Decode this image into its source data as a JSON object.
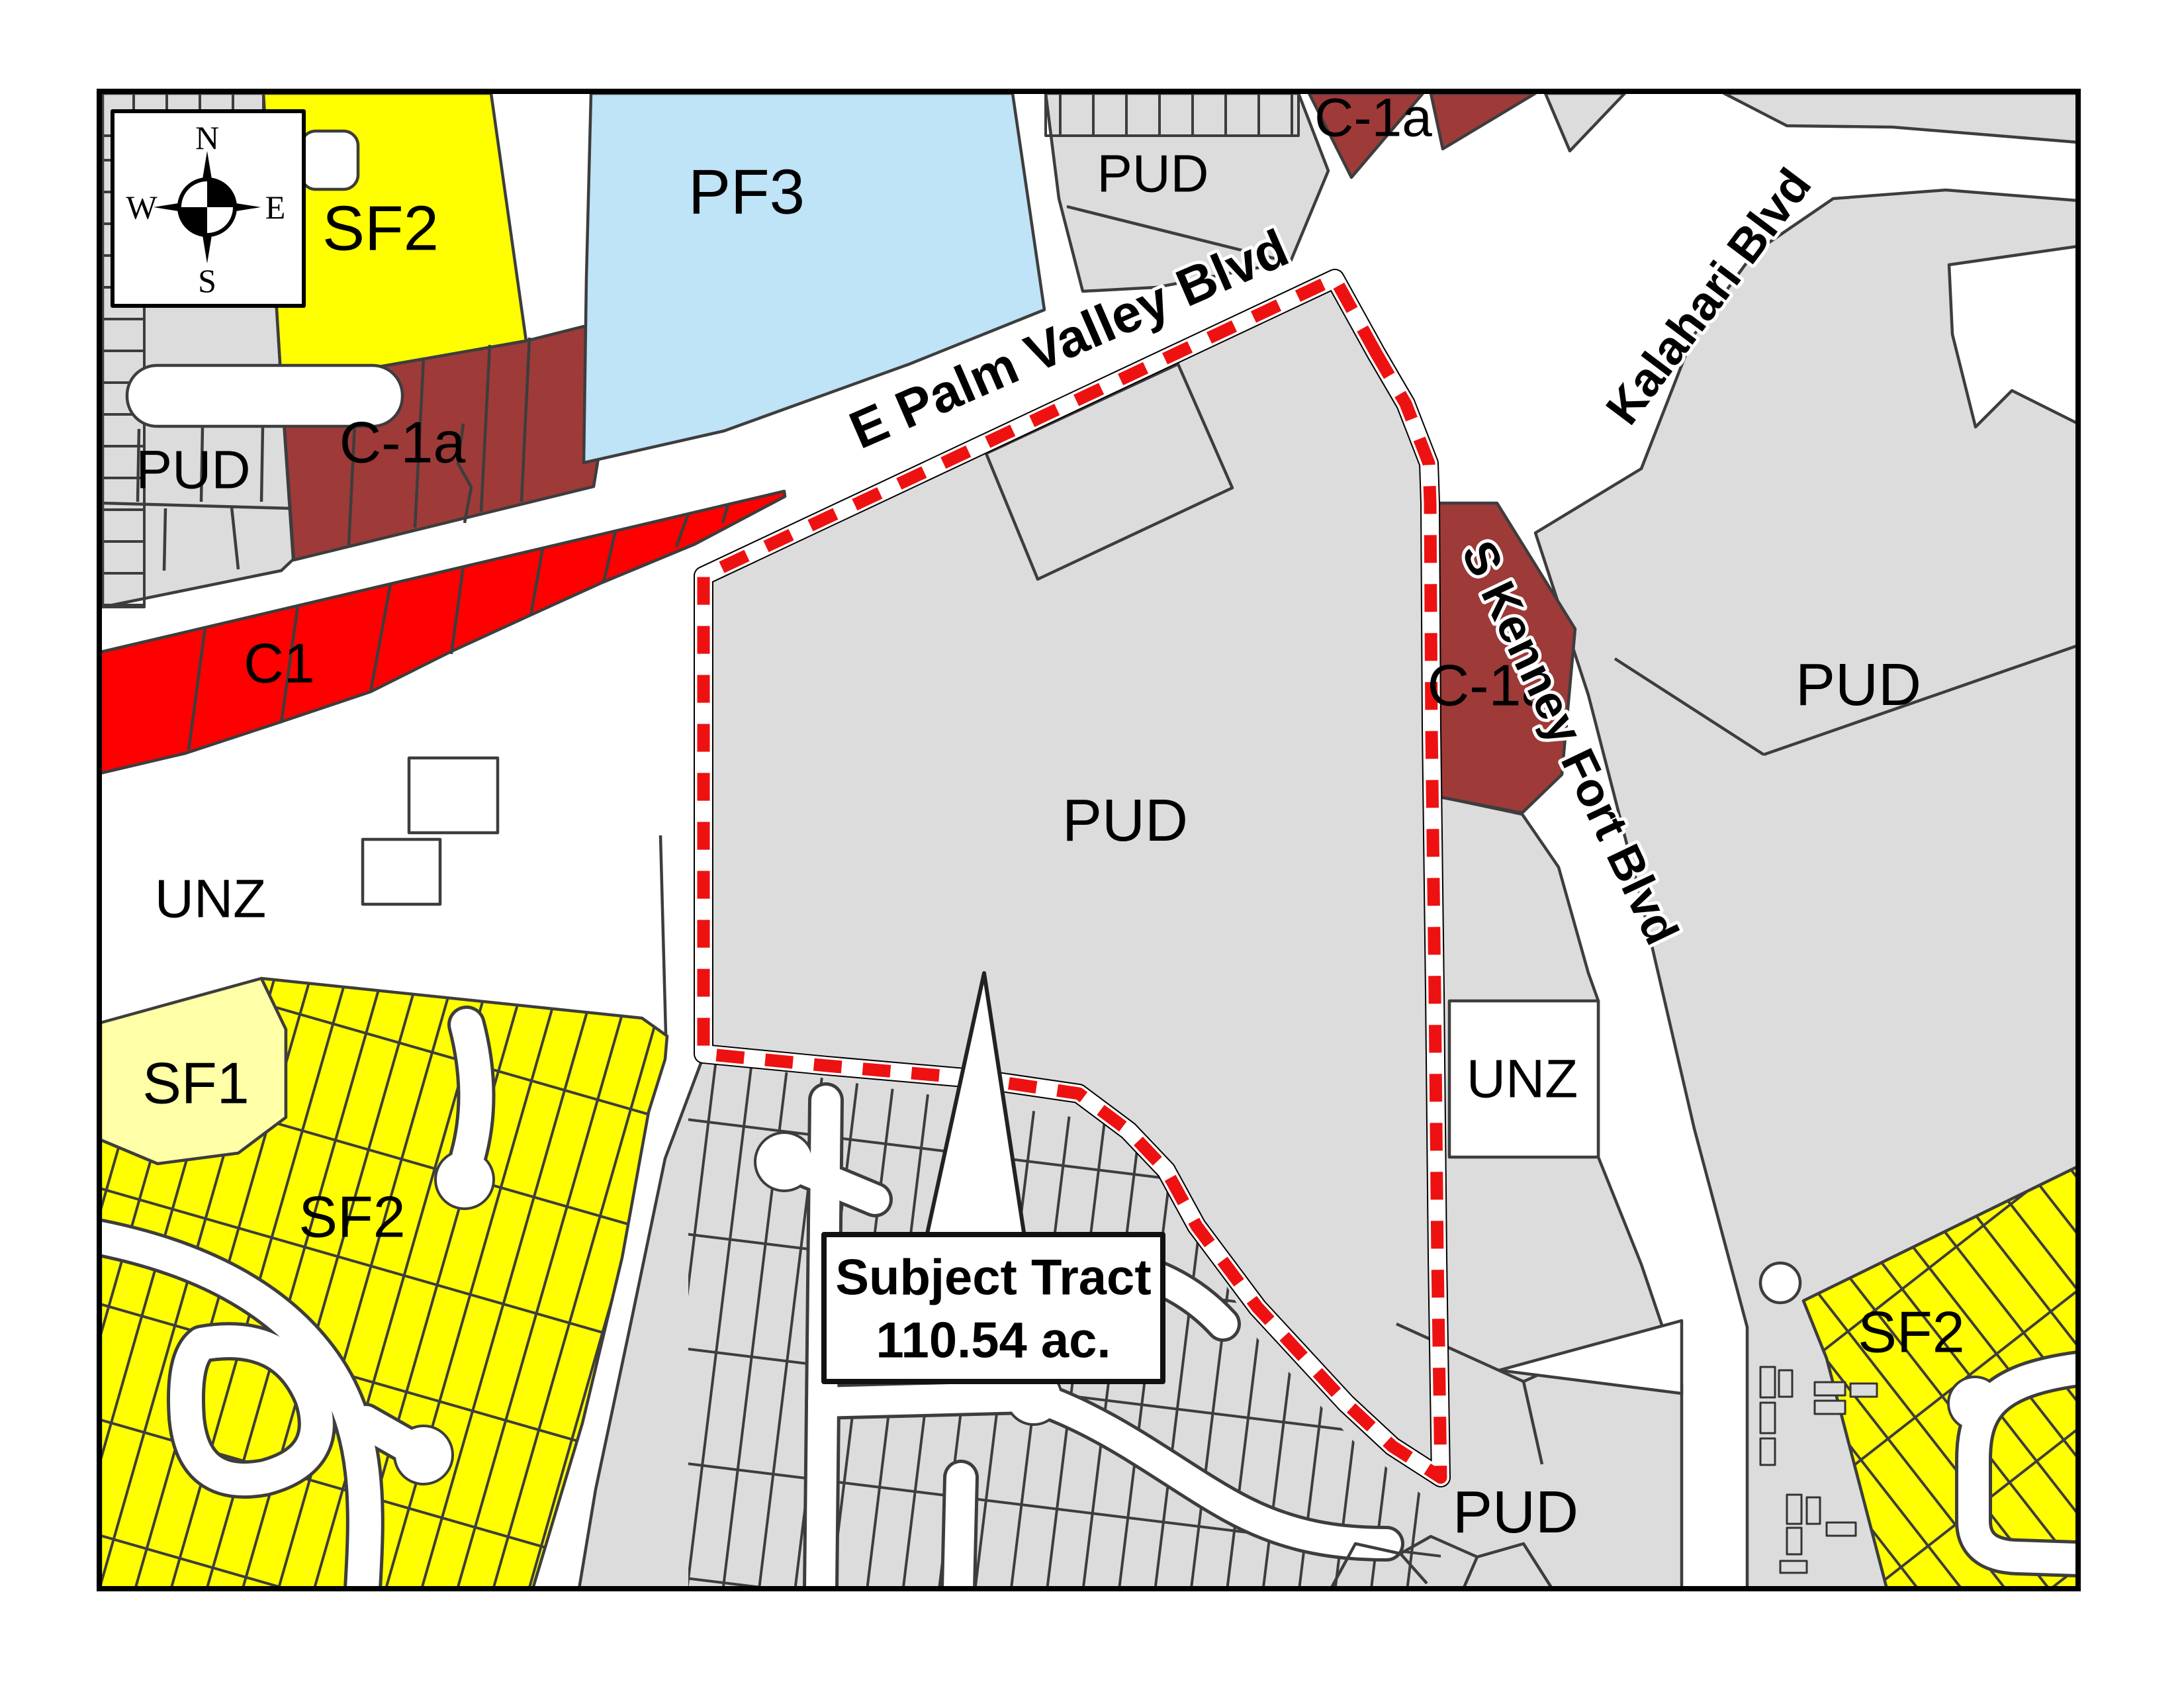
{
  "map": {
    "colors": {
      "background": "#ffffff",
      "frame": "#000000",
      "parcel_gray": "#dcdcdc",
      "outline": "#3d3d3d",
      "road_white": "#ffffff",
      "boundary_red": "#ee1111",
      "zone_yellow": "#ffff00",
      "zone_pale_yellow": "#ffffa8",
      "zone_blue": "#bfe3f7",
      "zone_dark_red": "#9e3a38",
      "zone_red": "#fe0000"
    },
    "compass": {
      "n": "N",
      "e": "E",
      "s": "S",
      "w": "W"
    },
    "zones": {
      "sf2_nw": {
        "label": "SF2",
        "color": "#ffff00"
      },
      "pf3": {
        "label": "PF3",
        "color": "#bfe3f7"
      },
      "pud_nw": {
        "label": "PUD",
        "color": "#dcdcdc"
      },
      "c1a_nw": {
        "label": "C-1a",
        "color": "#9e3a38"
      },
      "pud_n": {
        "label": "PUD",
        "color": "#dcdcdc"
      },
      "c1a_n": {
        "label": "C-1a",
        "color": "#9e3a38"
      },
      "c1": {
        "label": "C1",
        "color": "#fe0000"
      },
      "unz_w": {
        "label": "UNZ",
        "color": "#ffffff"
      },
      "pud_center": {
        "label": "PUD",
        "color": "#dcdcdc"
      },
      "c1a_e": {
        "label": "C-1a",
        "color": "#9e3a38"
      },
      "pud_e": {
        "label": "PUD",
        "color": "#dcdcdc"
      },
      "unz_e": {
        "label": "UNZ",
        "color": "#ffffff"
      },
      "sf1": {
        "label": "SF1",
        "color": "#ffffa8"
      },
      "sf2_sw": {
        "label": "SF2",
        "color": "#ffff00"
      },
      "sf2_se": {
        "label": "SF2",
        "color": "#ffff00"
      },
      "pud_s": {
        "label": "PUD",
        "color": "#dcdcdc"
      }
    },
    "streets": {
      "palm_valley": "E Palm Valley Blvd",
      "kalahari": "Kalahari Blvd",
      "kenney_fort": "S Kenney Fort Blvd"
    },
    "subject_tract": {
      "line1": "Subject Tract",
      "line2": "110.54 ac."
    }
  }
}
